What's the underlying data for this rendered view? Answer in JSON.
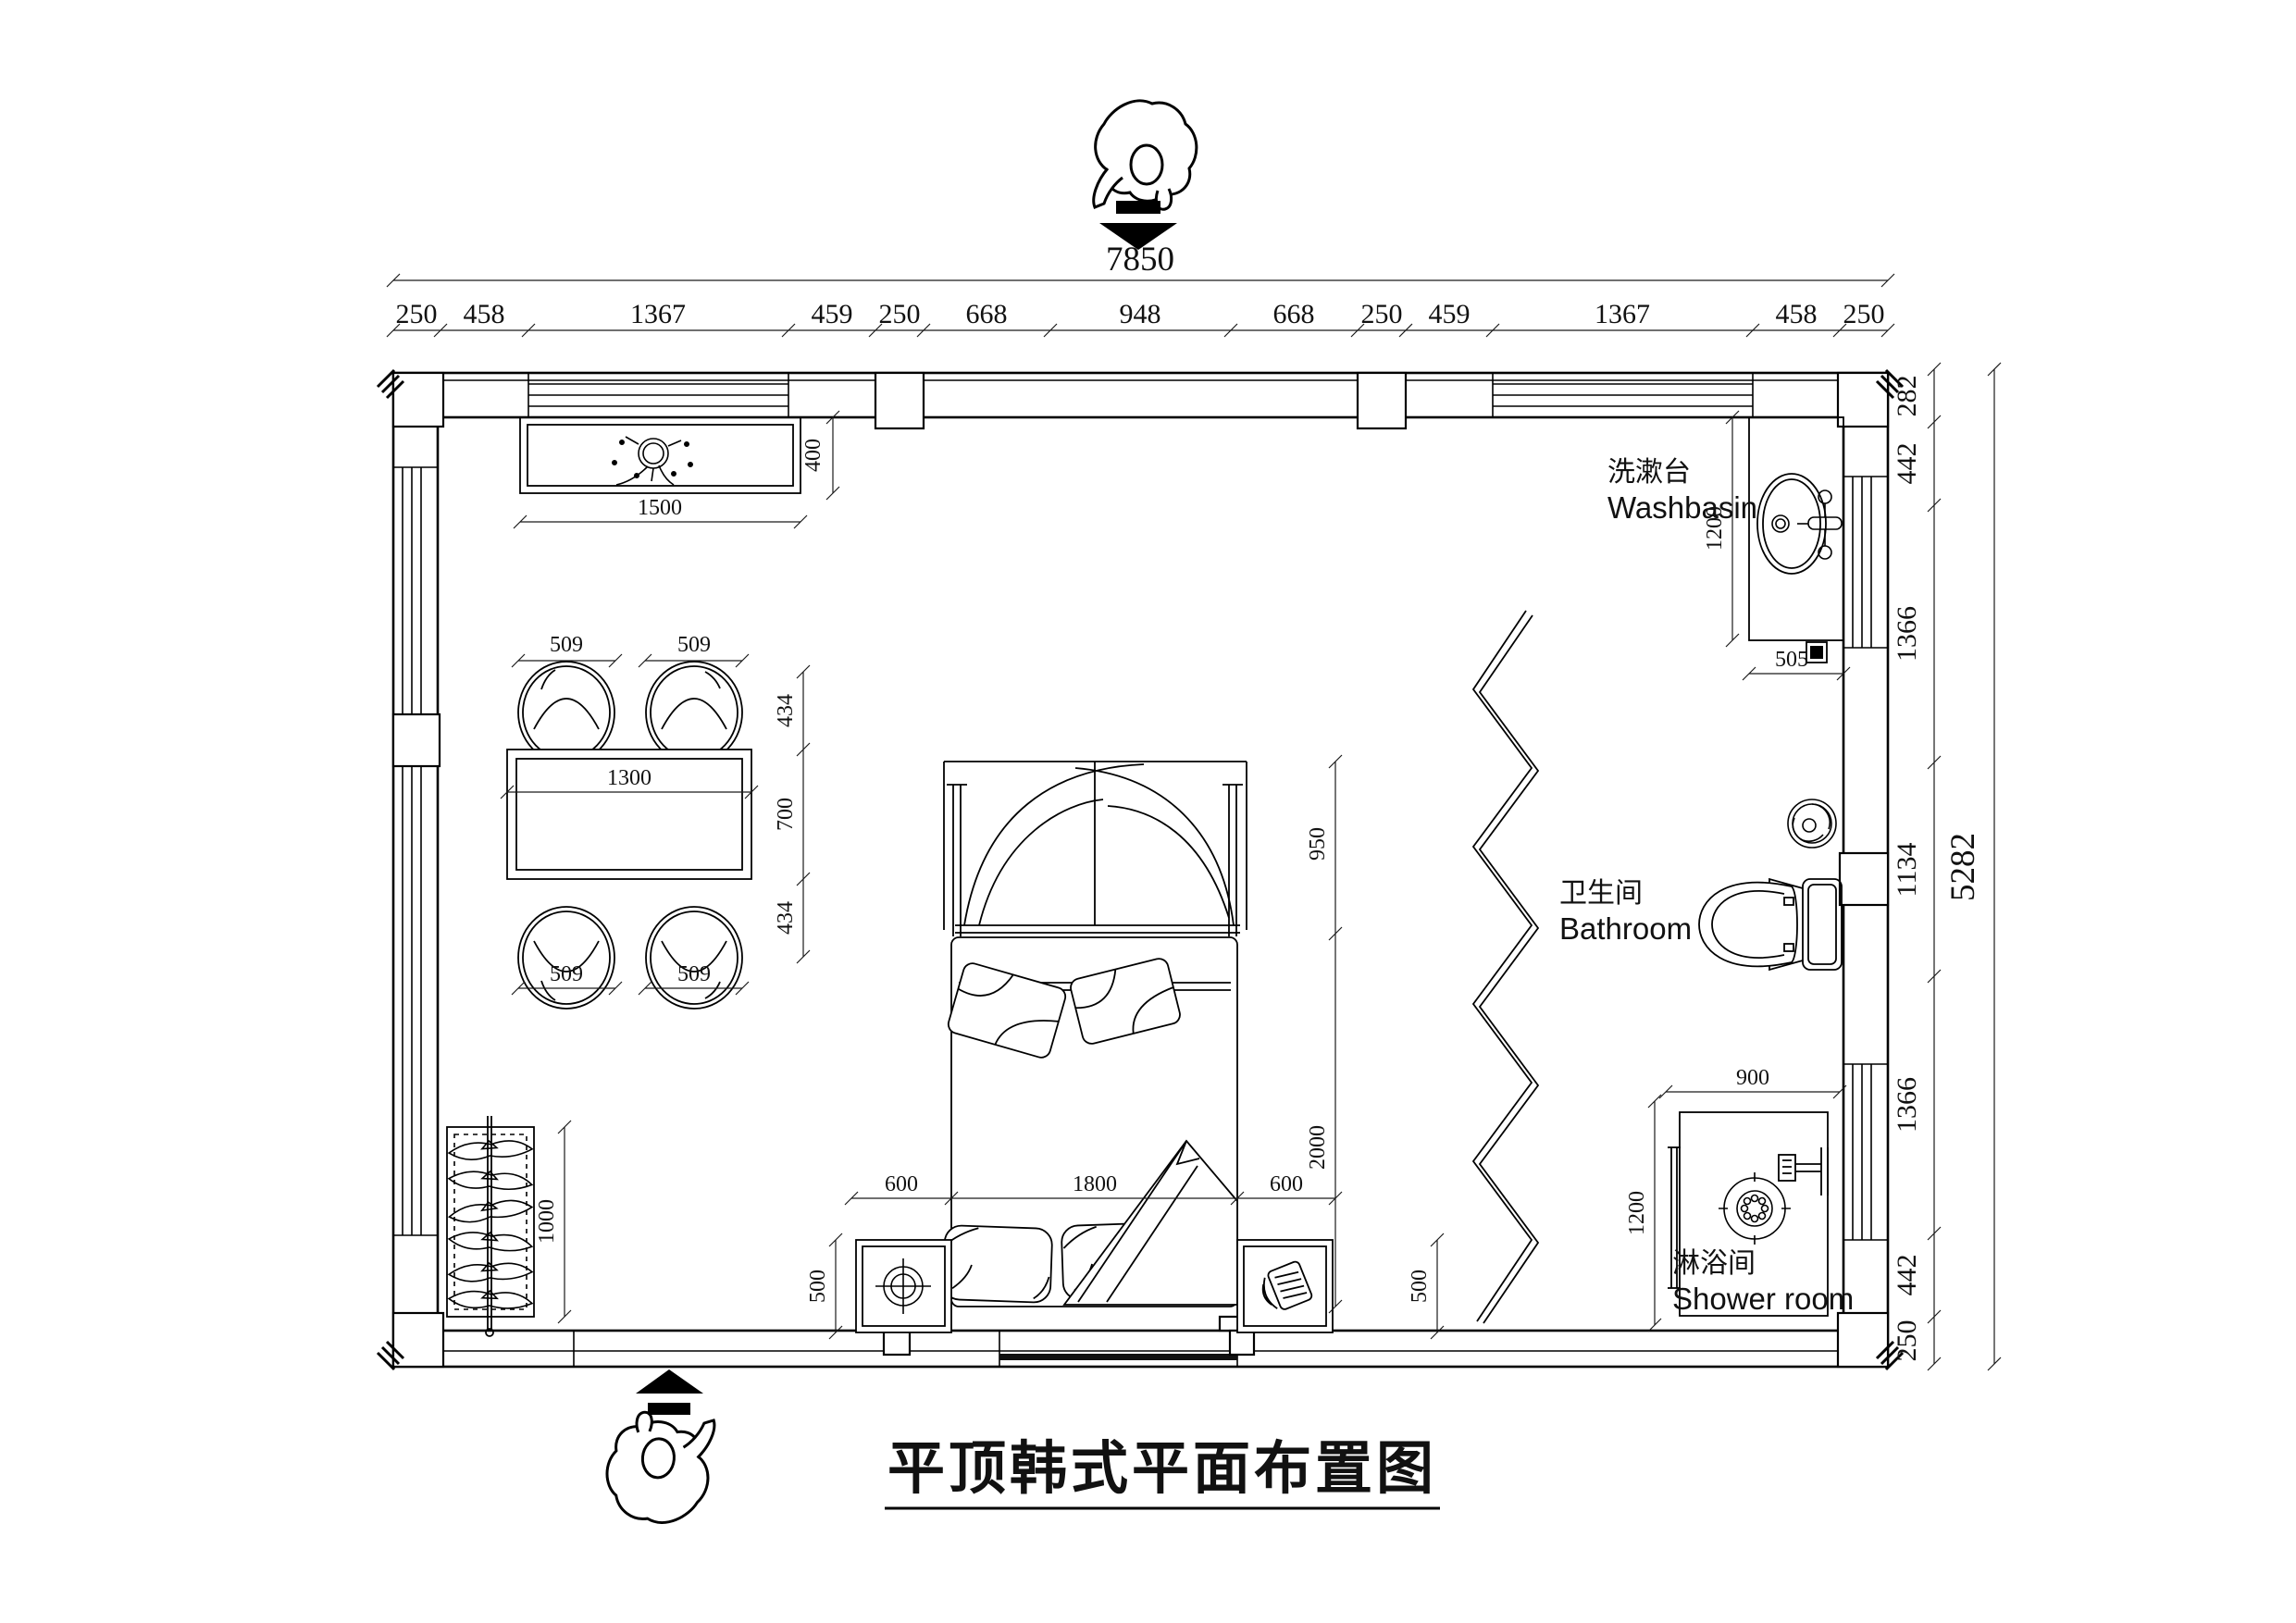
{
  "title": "平顶韩式平面布置图",
  "labels": {
    "washbasin_zh": "洗漱台",
    "washbasin_en": "Washbasin",
    "bathroom_zh": "卫生间",
    "bathroom_en": "Bathroom",
    "shower_zh": "淋浴间",
    "shower_en": "Shower room"
  },
  "dims": {
    "top_total": "7850",
    "top_chain": [
      "250",
      "458",
      "1367",
      "459",
      "250",
      "668",
      "948",
      "668",
      "250",
      "459",
      "1367",
      "458",
      "250"
    ],
    "right_total": "5282",
    "right_chain": [
      "282",
      "442",
      "1366",
      "1134",
      "1366",
      "442",
      "250"
    ],
    "cabinet": {
      "w": "1500",
      "d": "400"
    },
    "table": {
      "w": "1300",
      "d": "700",
      "chair": "509",
      "side": "434"
    },
    "bed": {
      "canopy": "950",
      "len": "2000",
      "w": "1800",
      "side": "600",
      "nightstand": "500"
    },
    "wardrobe": {
      "len": "1000"
    },
    "washbasin": {
      "d": "1200",
      "w": "505"
    },
    "shower": {
      "w": "900",
      "d": "1200"
    }
  }
}
